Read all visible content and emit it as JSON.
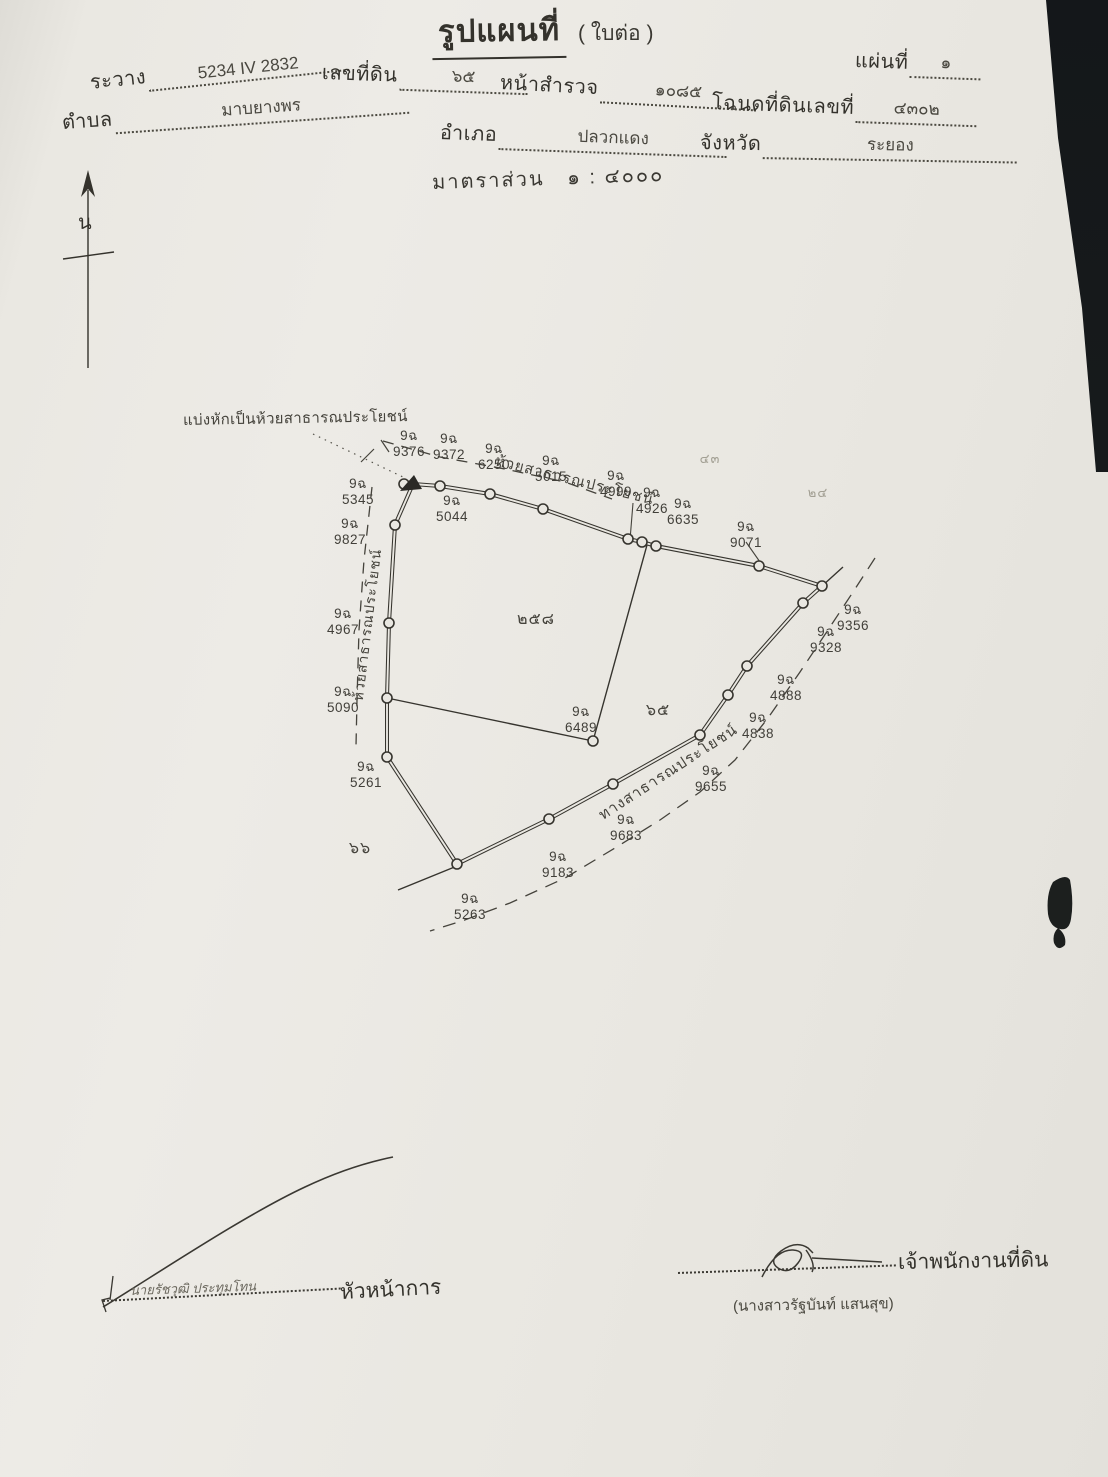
{
  "page": {
    "title": "รูปแผนที่",
    "subtitle": "( ใบต่อ )"
  },
  "header": {
    "fields": [
      {
        "label": "ระวาง",
        "value": "5234 IV 2832"
      },
      {
        "label": "เลขที่ดิน",
        "value": "๖๕"
      },
      {
        "label": "หน้าสำรวจ",
        "value": "๑๐๘๕"
      },
      {
        "label": "โฉนดที่ดินเลขที่",
        "value": "๔๓๐๒"
      },
      {
        "label": "แผ่นที่",
        "value": "๑"
      },
      {
        "label": "ตำบล",
        "value": "มาบยางพร"
      },
      {
        "label": "อำเภอ",
        "value": "ปลวกแดง"
      },
      {
        "label": "จังหวัด",
        "value": "ระยอง"
      }
    ],
    "scale_label": "มาตราส่วน",
    "scale_value": "๑ : ๔๐๐๐"
  },
  "compass": {
    "north_label": "น"
  },
  "map": {
    "note": "แบ่งหักเป็นห้วยสาธารณประโยชน์",
    "stream_label_top": "ห้วยสาธารณประโยชน์",
    "stream_label_left": "ห้วยสาธารณประโยชน์",
    "road_label": "ทางสาธารณประโยชน์",
    "parcel_labels": [
      {
        "text": "๒๕๘",
        "x": 536,
        "y": 607,
        "faint": false
      },
      {
        "text": "๖๕",
        "x": 658,
        "y": 698,
        "faint": false
      },
      {
        "text": "๖๖",
        "x": 360,
        "y": 836,
        "faint": false
      },
      {
        "text": "๔๓",
        "x": 710,
        "y": 448,
        "faint": true
      },
      {
        "text": "๒๔",
        "x": 818,
        "y": 482,
        "faint": true
      }
    ],
    "markers": [
      {
        "prefix": "9ฉ",
        "number": "9376",
        "x": 409,
        "y": 428
      },
      {
        "prefix": "9ฉ",
        "number": "9372",
        "x": 449,
        "y": 431
      },
      {
        "prefix": "9ฉ",
        "number": "6250",
        "x": 494,
        "y": 441
      },
      {
        "prefix": "9ฉ",
        "number": "5015",
        "x": 551,
        "y": 453
      },
      {
        "prefix": "9ฉ",
        "number": "4999",
        "x": 616,
        "y": 468
      },
      {
        "prefix": "9ฉ",
        "number": "4926",
        "x": 652,
        "y": 485
      },
      {
        "prefix": "9ฉ",
        "number": "6635",
        "x": 683,
        "y": 496
      },
      {
        "prefix": "9ฉ",
        "number": "9071",
        "x": 746,
        "y": 519
      },
      {
        "prefix": "9ฉ",
        "number": "5345",
        "x": 358,
        "y": 476
      },
      {
        "prefix": "9ฉ",
        "number": "9827",
        "x": 350,
        "y": 516
      },
      {
        "prefix": "9ฉ",
        "number": "5044",
        "x": 452,
        "y": 493
      },
      {
        "prefix": "9ฉ",
        "number": "4967",
        "x": 343,
        "y": 606
      },
      {
        "prefix": "9ฉ",
        "number": "5090",
        "x": 343,
        "y": 684
      },
      {
        "prefix": "9ฉ",
        "number": "6489",
        "x": 581,
        "y": 704
      },
      {
        "prefix": "9ฉ",
        "number": "9356",
        "x": 853,
        "y": 602
      },
      {
        "prefix": "9ฉ",
        "number": "9328",
        "x": 826,
        "y": 624
      },
      {
        "prefix": "9ฉ",
        "number": "4888",
        "x": 786,
        "y": 672
      },
      {
        "prefix": "9ฉ",
        "number": "4838",
        "x": 758,
        "y": 710
      },
      {
        "prefix": "9ฉ",
        "number": "9655",
        "x": 711,
        "y": 763
      },
      {
        "prefix": "9ฉ",
        "number": "9683",
        "x": 626,
        "y": 812
      },
      {
        "prefix": "9ฉ",
        "number": "9183",
        "x": 558,
        "y": 849
      },
      {
        "prefix": "9ฉ",
        "number": "5263",
        "x": 470,
        "y": 891
      },
      {
        "prefix": "9ฉ",
        "number": "5261",
        "x": 366,
        "y": 759
      }
    ]
  },
  "footer": {
    "left_name": "นายรัชวุฒิ ประทุมโทน",
    "left_title": "หัวหน้าการ",
    "right_title": "เจ้าพนักงานที่ดิน",
    "right_name": "(นางสาวรัฐบันท์ แสนสุข)"
  }
}
